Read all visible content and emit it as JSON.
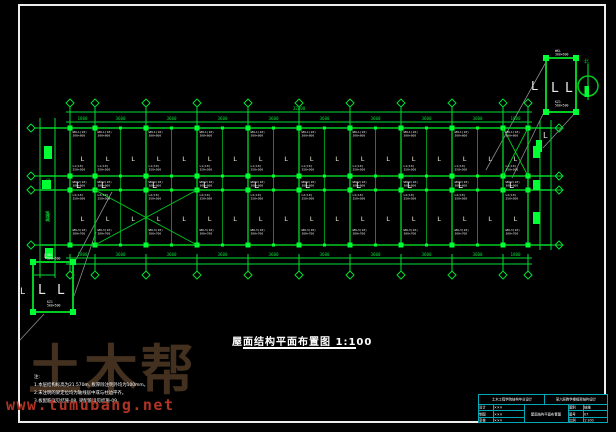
{
  "page": {
    "background": "#000000",
    "frame_color": "#ececec"
  },
  "colors": {
    "line_green": "#00cc22",
    "fill_green": "#00ff33",
    "dim_green": "#00dd33",
    "leader_gray": "#8c8c8c",
    "label_white": "#e9e9e9",
    "glyph_ivory": "#f2ecd2",
    "titleblock_cyan": "#00a8b8",
    "watermark_brown": "#43301f",
    "watermark_red": "#b03424"
  },
  "plan_title": {
    "text": "屋面结构平面布置图 1:100"
  },
  "notes": {
    "heading": "注:",
    "lines": [
      "1.本层结构标高为21.570m, 板厚除注明外均为100mm。",
      "2.未注明的梁定位均为轴线居中或与柱边平齐。",
      "3.板配筋详见结施-08, 梁配筋详见结施-09。"
    ]
  },
  "watermark": {
    "brand": "土木帮",
    "url": "www.tumubang.net"
  },
  "title_block": {
    "top_left": "土木工程学院结构毕业设计",
    "top_right": "某六层教学楼框架结构设计",
    "rows_left": [
      [
        "设计",
        "×××"
      ],
      [
        "制图",
        "×××"
      ],
      [
        "审核",
        "×××"
      ]
    ],
    "drawing_name": "屋面结构平面布置图",
    "rows_right": [
      [
        "图别",
        "结施"
      ],
      [
        "图号",
        "07"
      ],
      [
        "比例",
        "1:100"
      ]
    ]
  },
  "drawing": {
    "axes_x": [
      70,
      95,
      146,
      197,
      248,
      299,
      350,
      401,
      452,
      503,
      528
    ],
    "chords_y": [
      128,
      176,
      190,
      245
    ],
    "dims_top": [
      "1800",
      "3600",
      "3600",
      "3600",
      "3600",
      "3600",
      "3600",
      "3600",
      "3600",
      "1800"
    ],
    "dims_bottom": [
      "1800",
      "3600",
      "3600",
      "3600",
      "3600",
      "3600",
      "3600",
      "3600",
      "3600",
      "1800"
    ],
    "overall_top": "32400",
    "dims_left": [
      "3600",
      "1500",
      "3900"
    ],
    "left_vertical_dim": "8400",
    "beam_rows": [
      {
        "y": 133,
        "lines": [
          "WKL1(10)",
          "300×600"
        ]
      },
      {
        "y": 167,
        "lines": [
          "L1(10)",
          "250×500"
        ]
      },
      {
        "y": 183,
        "lines": [
          "WKL2(10)",
          "300×600"
        ]
      },
      {
        "y": 196,
        "lines": [
          "L2(10)",
          "250×500"
        ]
      },
      {
        "y": 231,
        "lines": [
          "WKL3(10)",
          "300×700"
        ]
      }
    ],
    "column_symbol": "L",
    "braces": [
      {
        "x1": 95,
        "y1": 190,
        "x2": 197,
        "y2": 245
      },
      {
        "x1": 503,
        "y1": 128,
        "x2": 528,
        "y2": 176
      }
    ],
    "leaders": [
      [
        112,
        192,
        74,
        263
      ],
      [
        96,
        232,
        74,
        296
      ],
      [
        44,
        314,
        20,
        340
      ],
      [
        486,
        170,
        546,
        62
      ],
      [
        512,
        178,
        546,
        108
      ],
      [
        576,
        112,
        543,
        148
      ]
    ],
    "details": {
      "a": {
        "x": 546,
        "y": 58,
        "w": 30,
        "h": 54
      },
      "b": {
        "x": 33,
        "y": 262,
        "w": 40,
        "h": 50
      },
      "label_top": [
        "WKL",
        "300×600"
      ],
      "label_bottom": [
        "KZ1",
        "500×500"
      ]
    },
    "north": {
      "cx": 588,
      "cy": 86,
      "r": 10,
      "label": "北"
    }
  }
}
